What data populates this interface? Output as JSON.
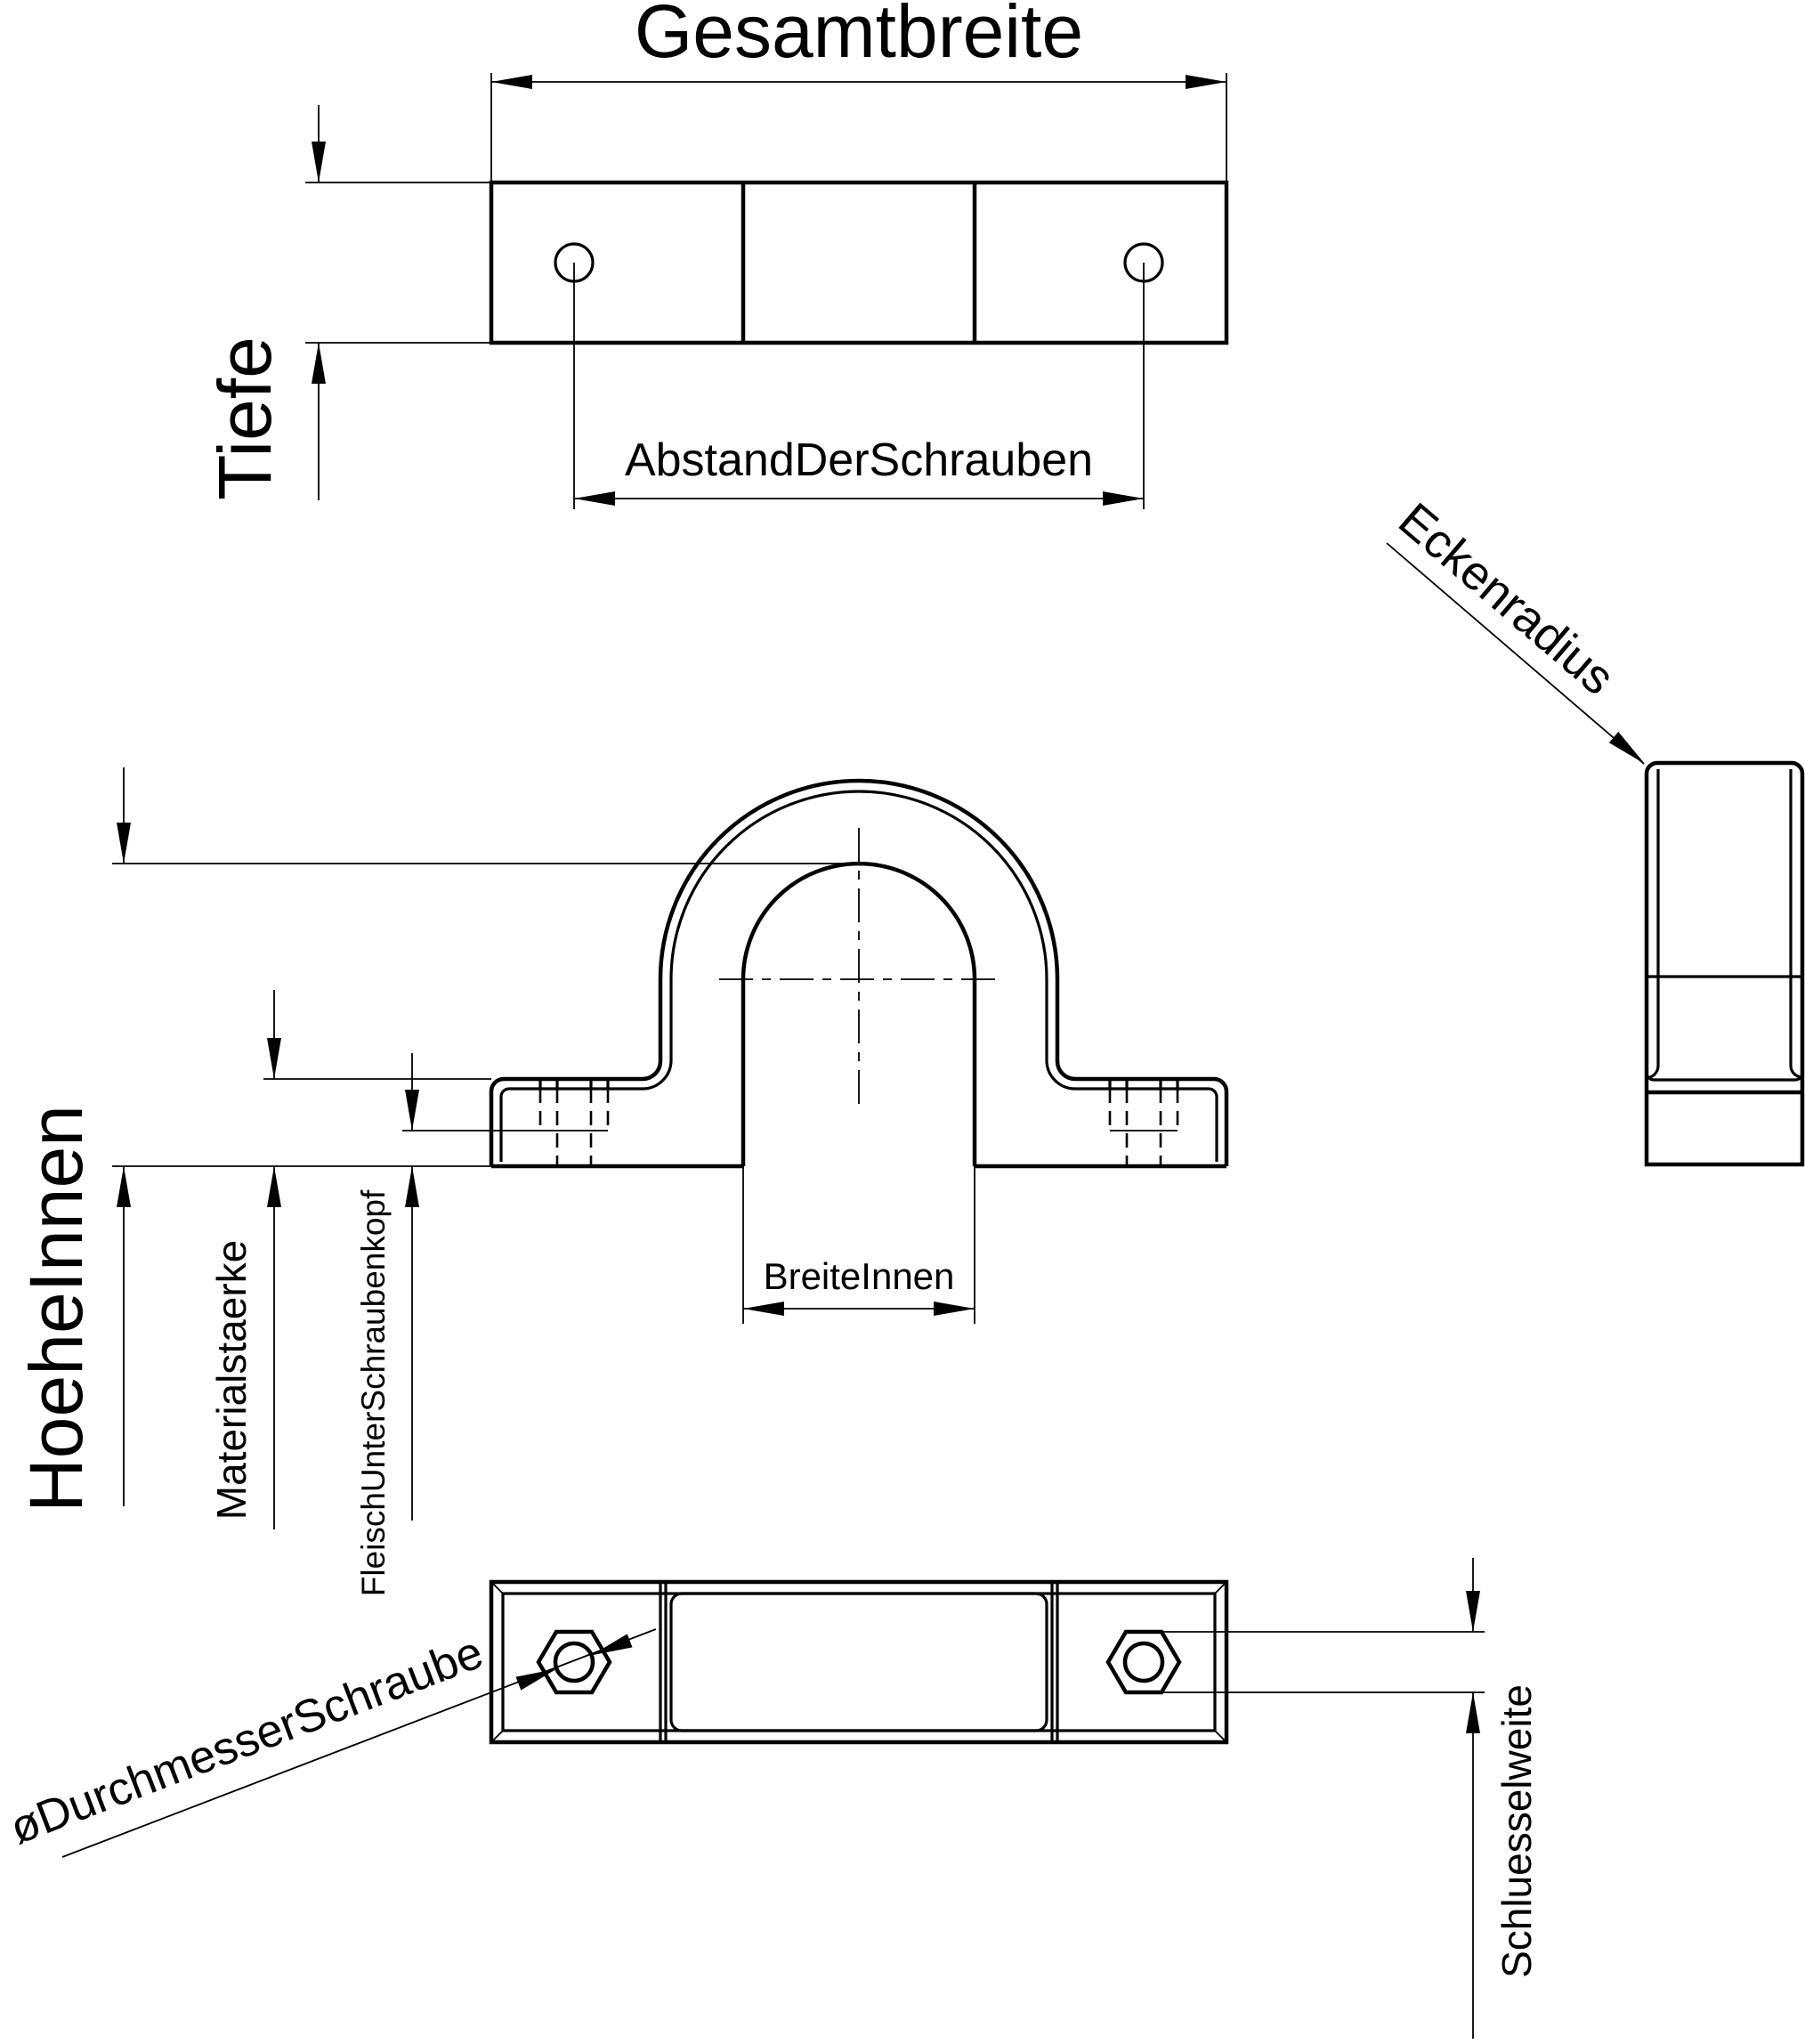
{
  "page": {
    "background_color": "#ffffff",
    "line_color": "#000000"
  },
  "drawing": {
    "type": "technical-cad-drawing",
    "part": "pipe-clamp",
    "labels": {
      "gesamtbreite": "Gesamtbreite",
      "tiefe": "Tiefe",
      "abstand_der_schrauben": "AbstandDerSchrauben",
      "eckenradius": "Eckenradius",
      "hoehe_innen": "HoeheInnen",
      "materialstaerke": "Materialstaerke",
      "fleisch_unter_schraubenkopf": "FleischUnterSchraubenkopf",
      "breite_innen": "BreiteInnen",
      "durchmesser_schraube": "øDurchmesserSchraube",
      "schluesselweite": "Schluesselweite"
    }
  }
}
